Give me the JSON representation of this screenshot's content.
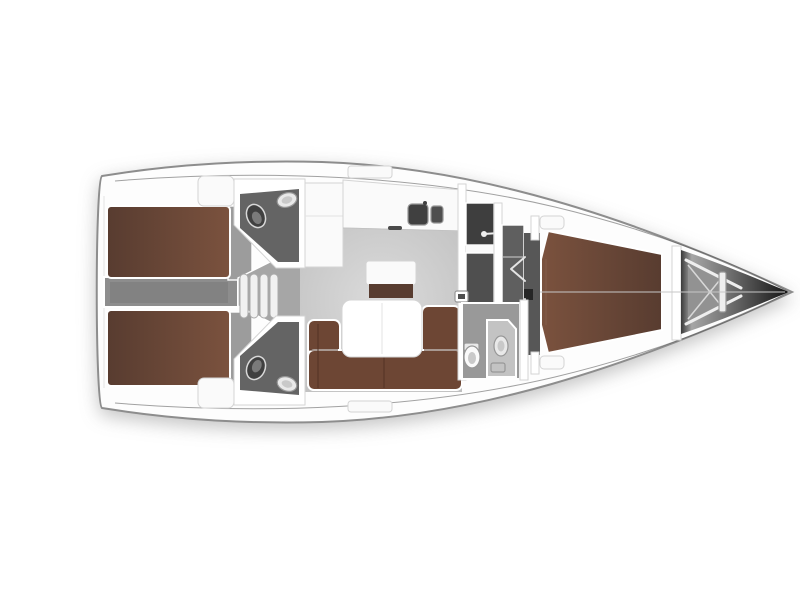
{
  "diagram": {
    "kind": "sailing-yacht-interior-floor-plan",
    "orientation": "bow-right",
    "areas": [
      "aft-cabin-port",
      "aft-cabin-starboard",
      "engine-corridor",
      "companionway-steps",
      "aft-head-port",
      "aft-head-starboard",
      "nav-cabinet",
      "galley",
      "salon",
      "salon-table",
      "u-sofa",
      "island-seat",
      "wet-locker",
      "vestibule",
      "forward-head",
      "forward-vberth-cabin",
      "anchor-locker",
      "bow-tip"
    ]
  },
  "colors": {
    "background": "#ffffff",
    "hull_fill": "#fdfdfd",
    "hull_outline": "#8d8d8d",
    "sheer_line": "#555555",
    "bed_dark": "#583c30",
    "bed_light": "#7b523e",
    "bed_seam": "#866350",
    "sofa": "#6d4634",
    "sofa_dark": "#523325",
    "table": "#ffffff",
    "furniture_white": "#fafafa",
    "corridor": "#8d8d8d",
    "corridor_inner": "#7c7c7c",
    "passage": "#a6a6a6",
    "floor_strip": "#9c9c9c",
    "salon_light": "#dbdbdb",
    "salon_dark": "#c0c0c0",
    "head_floor": "#646464",
    "fwd_head_floor": "#999999",
    "shower_panel": "#c3c3c3",
    "locker1": "#3e3e3e",
    "locker2": "#4f4f4f",
    "vestibule": "#5f5f5f",
    "entry_strip": "#575757",
    "mast": "#262626",
    "fixture_dark": "#404040",
    "fixture_mid": "#7a7a7a",
    "fixture_light": "#e9e9e9",
    "fixture_inner": "#c9c9c9",
    "wall_white": "#ffffff",
    "step_fill": "#f1f1f1",
    "anchor_floor": "#929292",
    "strut_white": "#eeeeee",
    "strut_soft": "#d8d8d8",
    "bow_shadow": "#3a3a3a",
    "bow_light": "#a6a6a6",
    "bow_mid": "#6f6f6f",
    "bow_dark": "#121212",
    "centerline": "#c7c7c7",
    "door_mark": "#e3e3e3",
    "seam_light": "#e6e6e6",
    "handle": "#4a4a4a"
  }
}
